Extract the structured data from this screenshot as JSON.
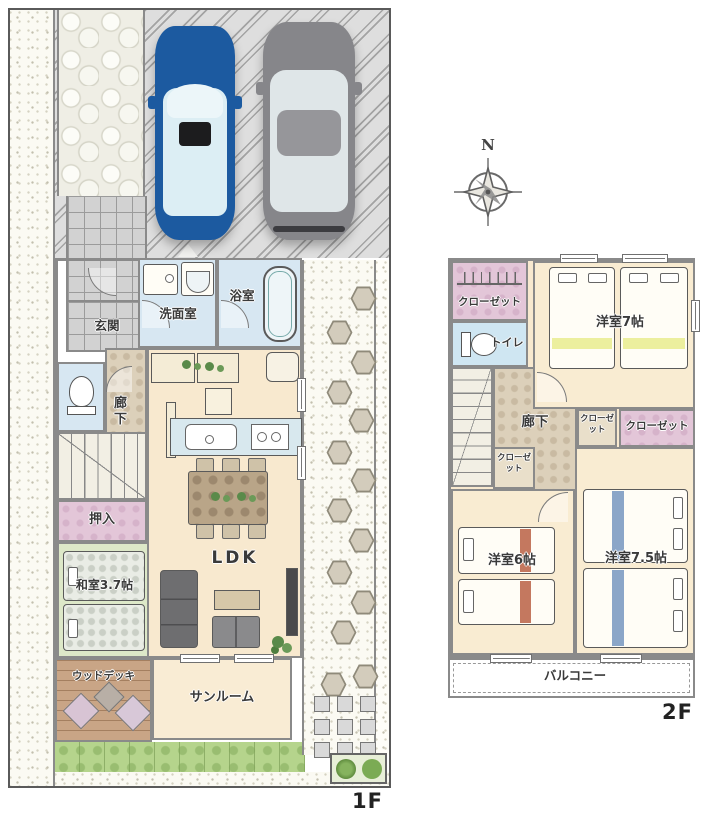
{
  "compass": {
    "north": "N"
  },
  "f1": {
    "label": "1F",
    "rooms": {
      "genkan": "玄関",
      "senmenshitsu": "洗面室",
      "yokushitsu": "浴室",
      "rouka": "廊下",
      "oshiire": "押入",
      "washitsu": "和室3.7帖",
      "ldk": "LDK",
      "sunroom": "サンルーム",
      "wooddeck": "ウッドデッキ"
    }
  },
  "f2": {
    "label": "2F",
    "rooms": {
      "closet": "クローゼット",
      "toilet": "トイレ",
      "bedroom7": "洋室7帖",
      "rouka": "廊下",
      "bedroom6": "洋室6帖",
      "bedroom75": "洋室7.5帖",
      "balcony": "バルコニー"
    }
  },
  "colors": {
    "wall": "#8a8a8a",
    "water_blue": "#d7e7f2",
    "floor_cream": "#f8e9cf",
    "closet_pink": "#e3c6d8",
    "tatami_green": "#dde8c8",
    "lawn_green": "#b5d48c",
    "deck_brown": "#c9a586",
    "car_blue": "#1c5aa0",
    "car_gray": "#86868a",
    "bed_stripe_yellow": "#ecef9e",
    "bed_stripe_red": "#c4785f",
    "bed_stripe_blue": "#8ba6c8"
  }
}
